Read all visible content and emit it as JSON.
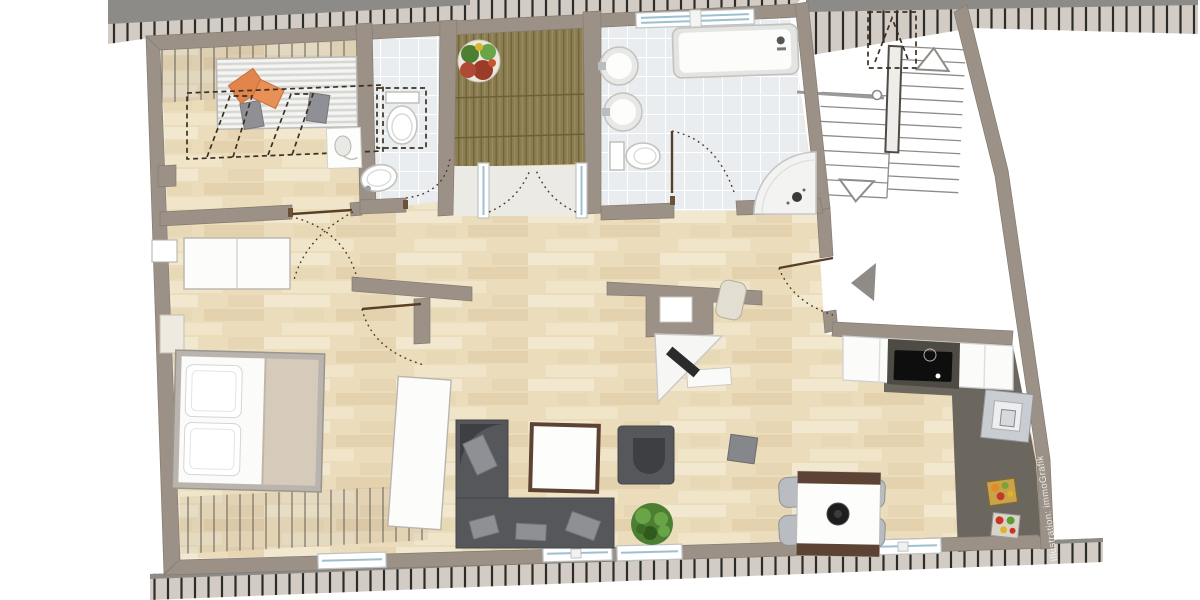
{
  "image": {
    "kind": "residential attic floor plan, top-down rendered view",
    "orientation": "plan slightly tilted, roof-edge hatching along top and bottom"
  },
  "watermark": {
    "text": "Illustration: immoGrafik"
  },
  "palette": {
    "wall": "#9c9187",
    "wall_edge": "#857b70",
    "wood": "#ebddbc",
    "wood_light": "#f4ebd3",
    "wood_dark": "#e0cba5",
    "tile": "#e9edef",
    "tile_line": "#ffffff",
    "deck": "#8b7d50",
    "deck_line": "#6b6036",
    "dark_floor": "#6b665e",
    "hatch_bg": "#d2ccc5",
    "hatch_tick": "#2e2c29",
    "sofa": "#56575b",
    "sofa_dark": "#3e3f43",
    "cushion": "#8f9095",
    "orange": "#e2854c",
    "plant": "#4c7f31",
    "plant_light": "#69a446",
    "table_frame": "#5d4334",
    "glass": "#9cc0d0",
    "door_leaf": "#5a3f28",
    "door_arc": "#4a3a26",
    "dashed": "#3c3022",
    "blanket": "#d6cabb",
    "stainless": "#c9cdd1"
  },
  "rooms": [
    {
      "id": "dressing-room",
      "features": [
        "striped-mat",
        "orange-cushions",
        "gray-cushions",
        "corner-basin",
        "roof-slope-dashed-outline"
      ]
    },
    {
      "id": "wc",
      "features": [
        "toilet-with-dashed-clearance",
        "washbasin"
      ]
    },
    {
      "id": "roof-terrace",
      "features": [
        "wood-decking",
        "flower-pot",
        "french-doors"
      ]
    },
    {
      "id": "bathroom",
      "features": [
        "bathtub",
        "two-round-washbasins",
        "toilet",
        "corner-shower",
        "top-window",
        "door"
      ]
    },
    {
      "id": "stairwell",
      "features": [
        "two-flight-stair",
        "up-arrow",
        "down-arrow",
        "handrail",
        "dashed-headroom-box"
      ]
    },
    {
      "id": "entrance-landing",
      "features": [
        "entrance-triangle-marker",
        "entry-door"
      ]
    },
    {
      "id": "bedroom",
      "features": [
        "double-bed",
        "sideboard",
        "wardrobe",
        "window",
        "knee-wall-hatching",
        "radiator"
      ]
    },
    {
      "id": "living-room",
      "features": [
        "corner-sofa",
        "coffee-table",
        "armchair",
        "potted-plant",
        "side-stool",
        "two-windows"
      ]
    },
    {
      "id": "study-corner",
      "features": [
        "partition-wall-with-niche",
        "corner-desk",
        "laptop",
        "desk-chair",
        "white-bench"
      ]
    },
    {
      "id": "dining-area",
      "features": [
        "dining-table",
        "four-chairs",
        "black-bowl",
        "window"
      ]
    },
    {
      "id": "kitchen",
      "features": [
        "counter-row",
        "black-cooktop",
        "stainless-unit",
        "fruit-crates",
        "dark-tile-floor"
      ]
    }
  ]
}
